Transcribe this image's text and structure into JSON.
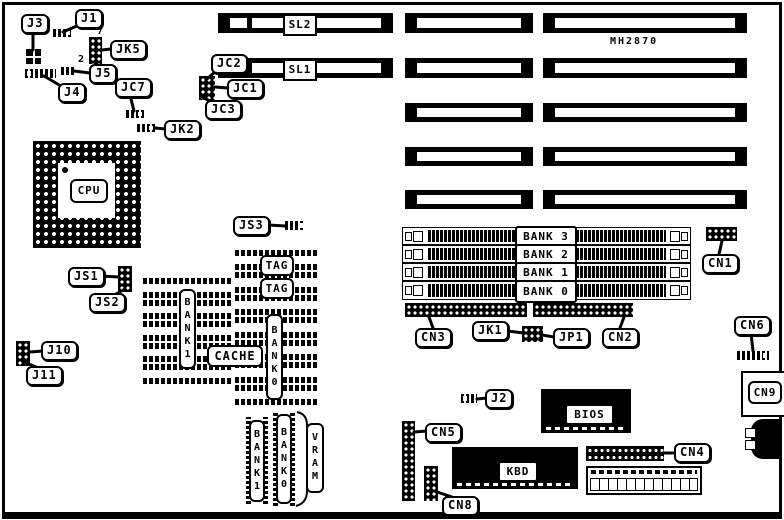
{
  "board": {
    "model": "MH2870"
  },
  "cpu": {
    "label": "CPU"
  },
  "slots": {
    "sl2": "SL2",
    "sl1": "SL1"
  },
  "connectors": {
    "j1": "J1",
    "j3": "J3",
    "j4": "J4",
    "j5": "J5",
    "jk5": "JK5",
    "jc7": "JC7",
    "jk2": "JK2",
    "jc1": "JC1",
    "jc2": "JC2",
    "jc3": "JC3",
    "js1": "JS1",
    "js2": "JS2",
    "js3": "JS3",
    "j10": "J10",
    "j11": "J11",
    "j2": "J2",
    "jk1": "JK1",
    "jp1": "JP1",
    "cn1": "CN1",
    "cn2": "CN2",
    "cn3": "CN3",
    "cn4": "CN4",
    "cn5": "CN5",
    "cn6": "CN6",
    "cn8": "CN8",
    "cn9": "CN9"
  },
  "jumper_pin_numbers": {
    "jk5_top": "7",
    "jk5_bottom": "2"
  },
  "cache": {
    "tag": "TAG",
    "cache": "CACHE",
    "bank1": "BANK1",
    "bank0": "BANK0"
  },
  "simm": {
    "banks": [
      "BANK 3",
      "BANK 2",
      "BANK 1",
      "BANK 0"
    ]
  },
  "video_memory": {
    "bank1": "BANK1",
    "bank0": "BANK0",
    "group": "VRAM"
  },
  "chips": {
    "bios": "BIOS",
    "kbd": "KBD"
  }
}
